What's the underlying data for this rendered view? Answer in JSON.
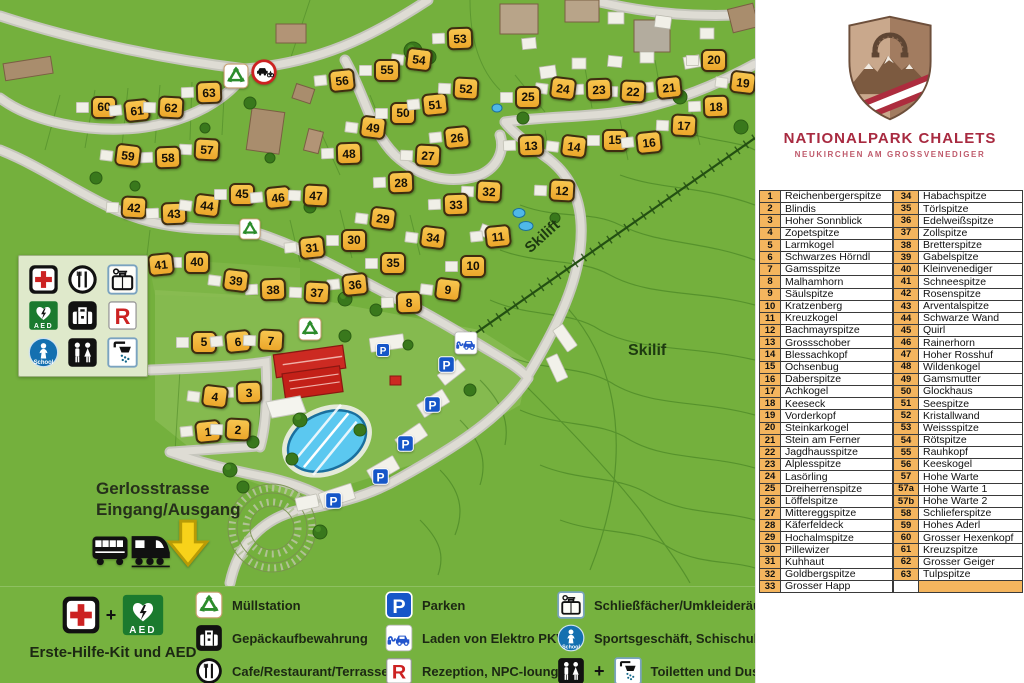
{
  "brand": {
    "title": "NATIONALPARK CHALETS",
    "subtitle": "NEUKIRCHEN AM GROSSVENEDIGER"
  },
  "map": {
    "labels": {
      "street": "Gerlosstrasse",
      "entrance": "Eingang/Ausgang",
      "skilift": "Skilift",
      "skilif": "Skilif"
    },
    "chalets": [
      [
        "1",
        208,
        431
      ],
      [
        "2",
        238,
        429
      ],
      [
        "3",
        249,
        392
      ],
      [
        "4",
        215,
        396
      ],
      [
        "5",
        204,
        342
      ],
      [
        "6",
        238,
        341
      ],
      [
        "7",
        271,
        340
      ],
      [
        "8",
        409,
        302
      ],
      [
        "9",
        448,
        289
      ],
      [
        "10",
        473,
        266
      ],
      [
        "11",
        498,
        236
      ],
      [
        "12",
        562,
        190
      ],
      [
        "13",
        531,
        145
      ],
      [
        "14",
        574,
        146
      ],
      [
        "15",
        615,
        140
      ],
      [
        "16",
        649,
        142
      ],
      [
        "17",
        684,
        125
      ],
      [
        "18",
        716,
        106
      ],
      [
        "19",
        743,
        82
      ],
      [
        "20",
        714,
        60
      ],
      [
        "21",
        669,
        87
      ],
      [
        "22",
        633,
        91
      ],
      [
        "23",
        599,
        89
      ],
      [
        "24",
        563,
        88
      ],
      [
        "25",
        528,
        97
      ],
      [
        "26",
        457,
        137
      ],
      [
        "27",
        428,
        155
      ],
      [
        "28",
        401,
        182
      ],
      [
        "29",
        383,
        218
      ],
      [
        "30",
        354,
        240
      ],
      [
        "31",
        312,
        247
      ],
      [
        "32",
        489,
        191
      ],
      [
        "33",
        456,
        204
      ],
      [
        "34",
        433,
        237
      ],
      [
        "35",
        393,
        263
      ],
      [
        "36",
        355,
        284
      ],
      [
        "37",
        317,
        292
      ],
      [
        "38",
        273,
        289
      ],
      [
        "39",
        236,
        280
      ],
      [
        "40",
        197,
        262
      ],
      [
        "41",
        161,
        264
      ],
      [
        "42",
        134,
        207
      ],
      [
        "43",
        174,
        213
      ],
      [
        "44",
        207,
        205
      ],
      [
        "45",
        242,
        194
      ],
      [
        "46",
        278,
        197
      ],
      [
        "47",
        316,
        195
      ],
      [
        "48",
        349,
        153
      ],
      [
        "49",
        373,
        127
      ],
      [
        "50",
        403,
        113
      ],
      [
        "51",
        435,
        104
      ],
      [
        "52",
        466,
        88
      ],
      [
        "53",
        460,
        38
      ],
      [
        "54",
        419,
        59
      ],
      [
        "55",
        387,
        70
      ],
      [
        "56",
        342,
        80
      ],
      [
        "57",
        207,
        149
      ],
      [
        "58",
        168,
        157
      ],
      [
        "59",
        128,
        155
      ],
      [
        "60",
        104,
        107
      ],
      [
        "61",
        137,
        110
      ],
      [
        "62",
        171,
        107
      ],
      [
        "63",
        209,
        92
      ]
    ],
    "icons": [
      {
        "icon": "recycle",
        "x": 236,
        "y": 76,
        "s": 26
      },
      {
        "icon": "noentry",
        "x": 264,
        "y": 72,
        "s": 26
      },
      {
        "icon": "recycle",
        "x": 250,
        "y": 229,
        "s": 22
      },
      {
        "icon": "recycle",
        "x": 310,
        "y": 329,
        "s": 24
      },
      {
        "icon": "parken",
        "x": 383,
        "y": 350,
        "s": 14
      },
      {
        "icon": "echarge",
        "x": 466,
        "y": 343,
        "s": 24
      },
      {
        "icon": "parken",
        "x": 446,
        "y": 364,
        "s": 17
      },
      {
        "icon": "parken",
        "x": 432,
        "y": 404,
        "s": 17
      },
      {
        "icon": "parken",
        "x": 405,
        "y": 443,
        "s": 17
      },
      {
        "icon": "parken",
        "x": 380,
        "y": 476,
        "s": 17
      },
      {
        "icon": "parken",
        "x": 333,
        "y": 500,
        "s": 17
      },
      {
        "icon": "bus",
        "x": 110,
        "y": 549,
        "s": 40
      },
      {
        "icon": "train",
        "x": 150,
        "y": 548,
        "s": 44
      },
      {
        "icon": "arrowdown",
        "x": 188,
        "y": 543,
        "s": 50
      }
    ],
    "facility_icons": [
      "firstaid",
      "food",
      "locker",
      "aed",
      "luggage",
      "rezeption",
      "school",
      "wc",
      "shower"
    ]
  },
  "legend": {
    "plus": "+",
    "col1": {
      "icons": [
        "firstaid",
        "aed"
      ],
      "label": "Erste-Hilfe-Kit und AED"
    },
    "col2": [
      {
        "icons": [
          "recycle"
        ],
        "label": "Müllstation"
      },
      {
        "icons": [
          "luggage"
        ],
        "label": "Gepäckaufbewahrung"
      },
      {
        "icons": [
          "food"
        ],
        "label": "Cafe/Restaurant/Terrasse"
      }
    ],
    "col3": [
      {
        "icons": [
          "parken"
        ],
        "label": "Parken"
      },
      {
        "icons": [
          "echarge"
        ],
        "label": "Laden von Elektro PKW"
      },
      {
        "icons": [
          "rezeption"
        ],
        "label": "Rezeption, NPC-lounge"
      }
    ],
    "col4": [
      {
        "icons": [
          "locker"
        ],
        "label": "Schließfächer/Umkleideräume"
      },
      {
        "icons": [
          "school"
        ],
        "label": "Sportsgeschäft, Schischule"
      },
      {
        "icons": [
          "wc",
          "shower"
        ],
        "label": "Toiletten und Duschen"
      }
    ]
  },
  "icon_glyphs": {
    "parken": "P",
    "rezeption": "R",
    "aed": "AED",
    "school": "School"
  },
  "peaks_left": [
    {
      "num": "1",
      "name": "Reichenbergerspitze"
    },
    {
      "num": "2",
      "name": "Blindis"
    },
    {
      "num": "3",
      "name": "Hoher Sonnblick"
    },
    {
      "num": "4",
      "name": "Zopetspitze"
    },
    {
      "num": "5",
      "name": "Larmkogel"
    },
    {
      "num": "6",
      "name": "Schwarzes Hörndl"
    },
    {
      "num": "7",
      "name": "Gamsspitze"
    },
    {
      "num": "8",
      "name": "Malhamhorn"
    },
    {
      "num": "9",
      "name": "Säulspitze"
    },
    {
      "num": "10",
      "name": "Kratzenberg"
    },
    {
      "num": "11",
      "name": "Kreuzkogel"
    },
    {
      "num": "12",
      "name": "Bachmayrspitze"
    },
    {
      "num": "13",
      "name": "Grossschober"
    },
    {
      "num": "14",
      "name": "Blessachkopf"
    },
    {
      "num": "15",
      "name": "Ochsenbug"
    },
    {
      "num": "16",
      "name": "Daberspitze"
    },
    {
      "num": "17",
      "name": "Achkogel"
    },
    {
      "num": "18",
      "name": "Keeseck"
    },
    {
      "num": "19",
      "name": "Vorderkopf"
    },
    {
      "num": "20",
      "name": "Steinkarkogel"
    },
    {
      "num": "21",
      "name": "Stein am Ferner"
    },
    {
      "num": "22",
      "name": "Jagdhausspitze"
    },
    {
      "num": "23",
      "name": "Alplesspitze"
    },
    {
      "num": "24",
      "name": "Lasörling"
    },
    {
      "num": "25",
      "name": "Dreiherrenspitze"
    },
    {
      "num": "26",
      "name": "Löffelspitze"
    },
    {
      "num": "27",
      "name": "Mittereggspitze"
    },
    {
      "num": "28",
      "name": "Käferfeldeck"
    },
    {
      "num": "29",
      "name": "Hochalmspitze"
    },
    {
      "num": "30",
      "name": "Pillewizer"
    },
    {
      "num": "31",
      "name": "Kuhhaut"
    },
    {
      "num": "32",
      "name": "Goldbergspitze"
    },
    {
      "num": "33",
      "name": "Grosser Happ"
    }
  ],
  "peaks_right": [
    {
      "num": "34",
      "name": "Habachspitze"
    },
    {
      "num": "35",
      "name": "Törlspitze"
    },
    {
      "num": "36",
      "name": "Edelweißspitze"
    },
    {
      "num": "37",
      "name": "Zollspitze"
    },
    {
      "num": "38",
      "name": "Bretterspitze"
    },
    {
      "num": "39",
      "name": "Gabelspitze"
    },
    {
      "num": "40",
      "name": "Kleinvenediger"
    },
    {
      "num": "41",
      "name": "Schneespitze"
    },
    {
      "num": "42",
      "name": "Rosenspitze"
    },
    {
      "num": "43",
      "name": "Arventalspitze"
    },
    {
      "num": "44",
      "name": "Schwarze Wand"
    },
    {
      "num": "45",
      "name": "Quirl"
    },
    {
      "num": "46",
      "name": "Rainerhorn"
    },
    {
      "num": "47",
      "name": "Hoher Rosshuf"
    },
    {
      "num": "48",
      "name": "Wildenkogel"
    },
    {
      "num": "49",
      "name": "Gamsmutter"
    },
    {
      "num": "50",
      "name": "Glockhaus"
    },
    {
      "num": "51",
      "name": "Seespitze"
    },
    {
      "num": "52",
      "name": "Kristallwand"
    },
    {
      "num": "53",
      "name": "Weissspitze"
    },
    {
      "num": "54",
      "name": "Rötspitze"
    },
    {
      "num": "55",
      "name": "Rauhkopf"
    },
    {
      "num": "56",
      "name": "Keeskogel"
    },
    {
      "num": "57",
      "name": "Hohe Warte"
    },
    {
      "num": "57a",
      "name": "Hohe Warte 1"
    },
    {
      "num": "57b",
      "name": "Hohe Warte 2"
    },
    {
      "num": "58",
      "name": "Schlieferspitze"
    },
    {
      "num": "59",
      "name": "Hohes Aderl"
    },
    {
      "num": "60",
      "name": "Grosser Hexenkopf"
    },
    {
      "num": "61",
      "name": "Kreuzspitze"
    },
    {
      "num": "62",
      "name": "Grosser Geiger"
    },
    {
      "num": "63",
      "name": "Tulpspitze"
    },
    {
      "num": "",
      "name": "",
      "hl": true
    }
  ],
  "colors": {
    "map_green": "#74b03d",
    "chalet_orange": "#f3b139",
    "table_orange": "#f4b55e",
    "brand_red": "#a82a40",
    "road_gray": "#dcdbd3",
    "pool_blue": "#5bc8f0"
  }
}
